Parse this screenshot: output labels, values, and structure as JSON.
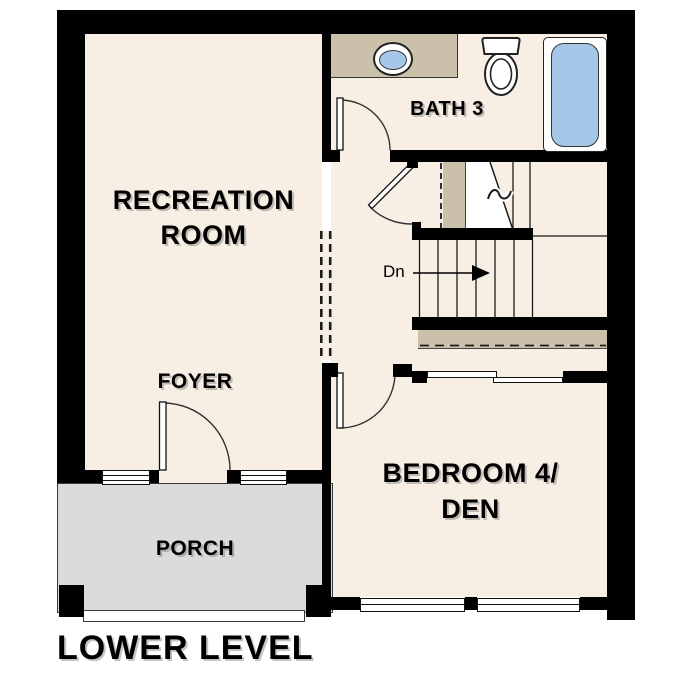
{
  "plan_title": "LOWER LEVEL",
  "rooms": {
    "recreation": {
      "label_line1": "RECREATION",
      "label_line2": "ROOM"
    },
    "bath": {
      "label": "BATH 3"
    },
    "foyer": {
      "label": "FOYER"
    },
    "bedroom": {
      "label_line1": "BEDROOM 4/",
      "label_line2": "DEN"
    },
    "porch": {
      "label": "PORCH"
    }
  },
  "stairs": {
    "direction_label": "Dn"
  },
  "fixtures": {
    "sink": "sink-icon",
    "toilet": "toilet-icon",
    "tub": "bathtub-icon"
  },
  "colors": {
    "floor": "#f7efe3",
    "counter_tan": "#cbc1aa",
    "fixture_blue": "#a6c8e8",
    "porch_gray": "#dbdbd9",
    "wall": "#000000",
    "background": "#ffffff"
  }
}
